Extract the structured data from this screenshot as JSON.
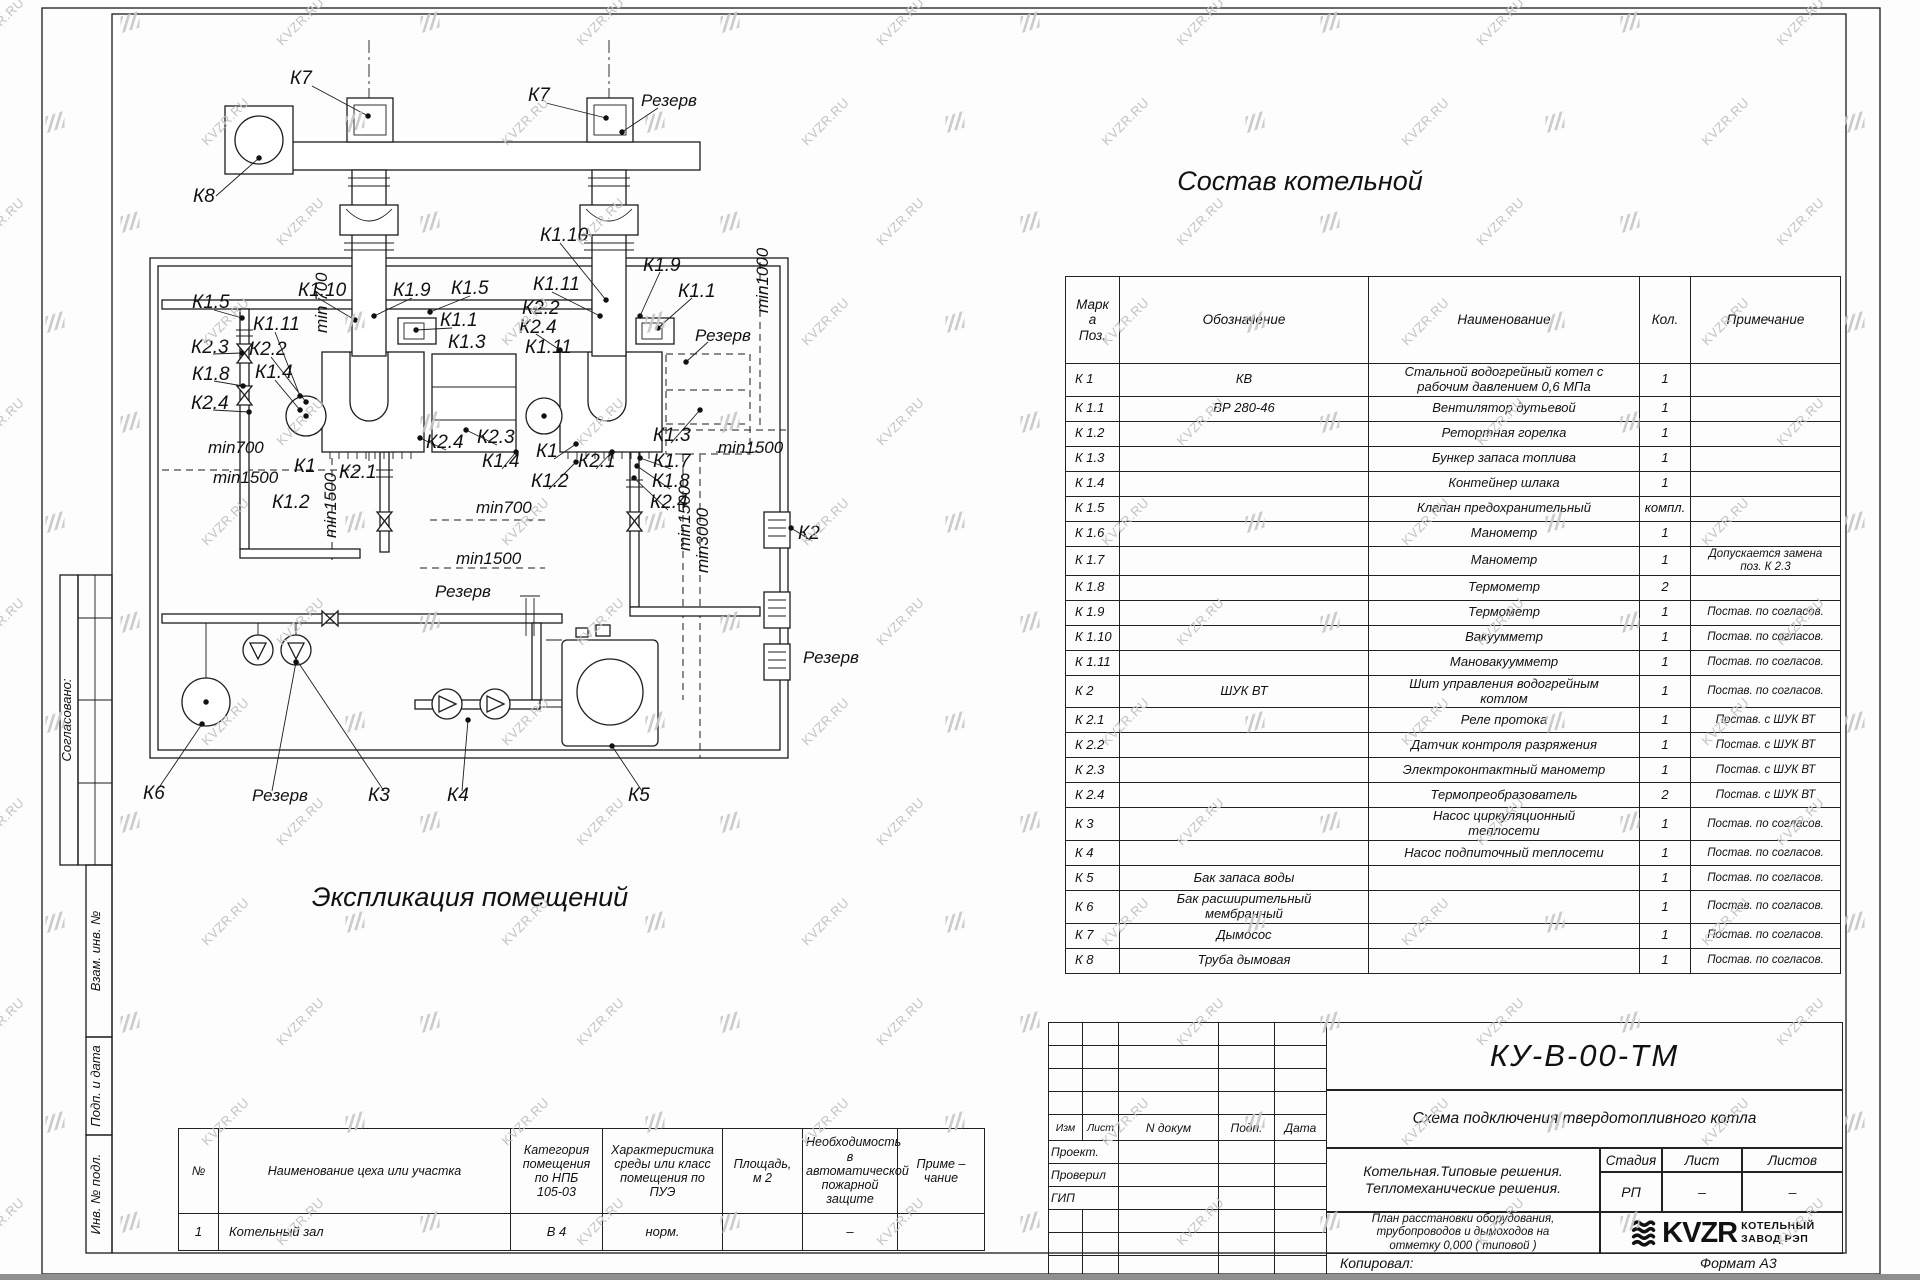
{
  "watermark": {
    "text": "KVZR.RU"
  },
  "sidebar": {
    "items": [
      "Согласовано:",
      "Взам. инв. №",
      "Подп. и дата",
      "Инв. № подл."
    ]
  },
  "drawing": {
    "labels": [
      {
        "t": "К7",
        "x": 290,
        "y": 84
      },
      {
        "t": "К7",
        "x": 528,
        "y": 101
      },
      {
        "t": "Резерв",
        "x": 641,
        "y": 106,
        "c": "dim"
      },
      {
        "t": "К8",
        "x": 193,
        "y": 202
      },
      {
        "t": "К1.10",
        "x": 540,
        "y": 241
      },
      {
        "t": "К1.9",
        "x": 643,
        "y": 271
      },
      {
        "t": "К1.1",
        "x": 678,
        "y": 297
      },
      {
        "t": "Резерв",
        "x": 695,
        "y": 341,
        "c": "dim"
      },
      {
        "t": "К1.5",
        "x": 192,
        "y": 308
      },
      {
        "t": "К1.10",
        "x": 298,
        "y": 296
      },
      {
        "t": "К1.9",
        "x": 393,
        "y": 296
      },
      {
        "t": "К1.5",
        "x": 451,
        "y": 294
      },
      {
        "t": "К1.11",
        "x": 533,
        "y": 290
      },
      {
        "t": "К2.2",
        "x": 522,
        "y": 314
      },
      {
        "t": "К2.4",
        "x": 519,
        "y": 333
      },
      {
        "t": "К1.11",
        "x": 253,
        "y": 330
      },
      {
        "t": "К2.3",
        "x": 191,
        "y": 353
      },
      {
        "t": "К2.2",
        "x": 249,
        "y": 355
      },
      {
        "t": "К1.1",
        "x": 440,
        "y": 326
      },
      {
        "t": "К1.3",
        "x": 448,
        "y": 348
      },
      {
        "t": "К1.8",
        "x": 192,
        "y": 380
      },
      {
        "t": "К1.4",
        "x": 255,
        "y": 378
      },
      {
        "t": "К2.4",
        "x": 191,
        "y": 409
      },
      {
        "t": "К1.11",
        "x": 525,
        "y": 353
      },
      {
        "t": "min1000",
        "x": 768,
        "y": 313,
        "r": -90,
        "c": "dim"
      },
      {
        "t": "min 700",
        "x": 327,
        "y": 333,
        "r": -90,
        "c": "dim"
      },
      {
        "t": "min700",
        "x": 208,
        "y": 453,
        "c": "dim"
      },
      {
        "t": "min1500",
        "x": 213,
        "y": 483,
        "c": "dim"
      },
      {
        "t": "К1",
        "x": 294,
        "y": 472
      },
      {
        "t": "К2.1",
        "x": 339,
        "y": 478
      },
      {
        "t": "К1.2",
        "x": 272,
        "y": 508
      },
      {
        "t": "min1500",
        "x": 336,
        "y": 538,
        "r": -90,
        "c": "dim"
      },
      {
        "t": "К2.4",
        "x": 426,
        "y": 448
      },
      {
        "t": "К2.3",
        "x": 477,
        "y": 443
      },
      {
        "t": "К1.4",
        "x": 482,
        "y": 467
      },
      {
        "t": "К1",
        "x": 536,
        "y": 457
      },
      {
        "t": "К2.1",
        "x": 578,
        "y": 467
      },
      {
        "t": "К1.2",
        "x": 531,
        "y": 487
      },
      {
        "t": "min700",
        "x": 476,
        "y": 513,
        "c": "dim"
      },
      {
        "t": "min1500",
        "x": 456,
        "y": 564,
        "c": "dim"
      },
      {
        "t": "К1.3",
        "x": 653,
        "y": 441
      },
      {
        "t": "К1.7",
        "x": 653,
        "y": 467
      },
      {
        "t": "К1.8",
        "x": 652,
        "y": 487
      },
      {
        "t": "К2.4",
        "x": 650,
        "y": 508
      },
      {
        "t": "min1500",
        "x": 718,
        "y": 453,
        "c": "dim"
      },
      {
        "t": "min1500",
        "x": 690,
        "y": 551,
        "r": -90,
        "c": "dim"
      },
      {
        "t": "min3000",
        "x": 708,
        "y": 573,
        "r": -90,
        "c": "dim"
      },
      {
        "t": "К2",
        "x": 798,
        "y": 539
      },
      {
        "t": "Резерв",
        "x": 803,
        "y": 663,
        "c": "dim"
      },
      {
        "t": "Резерв",
        "x": 435,
        "y": 597,
        "c": "dim"
      },
      {
        "t": "К6",
        "x": 143,
        "y": 799
      },
      {
        "t": "Резерв",
        "x": 252,
        "y": 801,
        "c": "dim"
      },
      {
        "t": "К3",
        "x": 368,
        "y": 801
      },
      {
        "t": "К4",
        "x": 447,
        "y": 801
      },
      {
        "t": "К5",
        "x": 628,
        "y": 801
      }
    ]
  },
  "composition_table": {
    "title": "Состав котельной",
    "headers": [
      "Марк\nа\nПоз.",
      "Обозначение",
      "Наименование",
      "Кол.",
      "Примечание"
    ],
    "rows": [
      [
        "К 1",
        "КВ",
        "Стальной водогрейный котел с\nрабочим давлением  0,6  МПа",
        "1",
        ""
      ],
      [
        "К 1.1",
        "ВР 280-46",
        "Вентилятор дутьевой",
        "1",
        ""
      ],
      [
        "К 1.2",
        "",
        "Ретортная горелка",
        "1",
        ""
      ],
      [
        "К 1.3",
        "",
        "Бункер запаса топлива",
        "1",
        ""
      ],
      [
        "К 1.4",
        "",
        "Контейнер шлака",
        "1",
        ""
      ],
      [
        "К 1.5",
        "",
        "Клапан предохранительный",
        "компл.",
        ""
      ],
      [
        "К 1.6",
        "",
        "Манометр",
        "1",
        ""
      ],
      [
        "К 1.7",
        "",
        "Манометр",
        "1",
        "Допускается замена\nпоз. К 2.3"
      ],
      [
        "К 1.8",
        "",
        "Термометр",
        "2",
        ""
      ],
      [
        "К 1.9",
        "",
        "Термометр",
        "1",
        "Постав. по согласов."
      ],
      [
        "К 1.10",
        "",
        "Вакуумметр",
        "1",
        "Постав. по согласов."
      ],
      [
        "К 1.11",
        "",
        "Мановакуумметр",
        "1",
        "Постав. по согласов."
      ],
      [
        "К 2",
        "ШУК ВТ",
        "Шит управления водогрейным\nкотлом",
        "1",
        "Постав. по согласов."
      ],
      [
        "К 2.1",
        "",
        "Реле протока",
        "1",
        "Постав. с ШУК ВТ"
      ],
      [
        "К 2.2",
        "",
        "Датчик контроля разряжения",
        "1",
        "Постав. с ШУК ВТ"
      ],
      [
        "К 2.3",
        "",
        "Электроконтактный манометр",
        "1",
        "Постав. с ШУК ВТ"
      ],
      [
        "К 2.4",
        "",
        "Термопреобразователь",
        "2",
        "Постав. с ШУК ВТ"
      ],
      [
        "К 3",
        "",
        "Насос циркуляционный\nтеплосети",
        "1",
        "Постав. по согласов."
      ],
      [
        "К 4",
        "",
        "Насос подпиточный теплосети",
        "1",
        "Постав. по согласов."
      ],
      [
        "К 5",
        "Бак запаса воды",
        "",
        "1",
        "Постав. по согласов."
      ],
      [
        "К 6",
        "Бак расширительный\nмембранный",
        "",
        "1",
        "Постав. по согласов."
      ],
      [
        "К 7",
        "Дымосос",
        "",
        "1",
        "Постав. по согласов."
      ],
      [
        "К 8",
        "Труба дымовая",
        "",
        "1",
        "Постав. по согласов."
      ]
    ]
  },
  "explication_table": {
    "title": "Экспликация помещений",
    "headers": [
      "№",
      "Наименование цеха или участка",
      "Категория\nпомещения\nпо НПБ\n105-03",
      "Характеристика\nсреды или класс\nпомещения по\nПУЭ",
      "Площадь,\nм 2",
      "Необходимость в\nавтоматической\nпожарной защите",
      "Приме –\nчание"
    ],
    "rows": [
      [
        "1",
        "Котельный зал",
        "В 4",
        "норм.",
        "",
        "–",
        ""
      ]
    ]
  },
  "title_block": {
    "doc_number": "КУ-В-00-ТМ",
    "doc_title": "Схема подключения твердотопливного котла",
    "cols": [
      "Изм",
      "Лист",
      "N докум",
      "Подп.",
      "Дата"
    ],
    "roles": [
      "Проект.",
      "Проверил",
      "ГИП"
    ],
    "org": "Котельная.Типовые решения.\nТепломеханические решения.",
    "stage_label": "Стадия",
    "sheet_label": "Лист",
    "sheets_label": "Листов",
    "stage_value": "РП",
    "sheet_value": "–",
    "sheets_value": "–",
    "description": "План расстановки оборудования,\nтрубопроводов и дымоходов на\nотметку  0,000  ( типовой )",
    "logo_text": "KVZR",
    "logo_caption": "КОТЕЛЬНЫЙ\nЗАВОД РЭП",
    "copied_label": "Копировал:",
    "format_label": "Формат А3"
  }
}
